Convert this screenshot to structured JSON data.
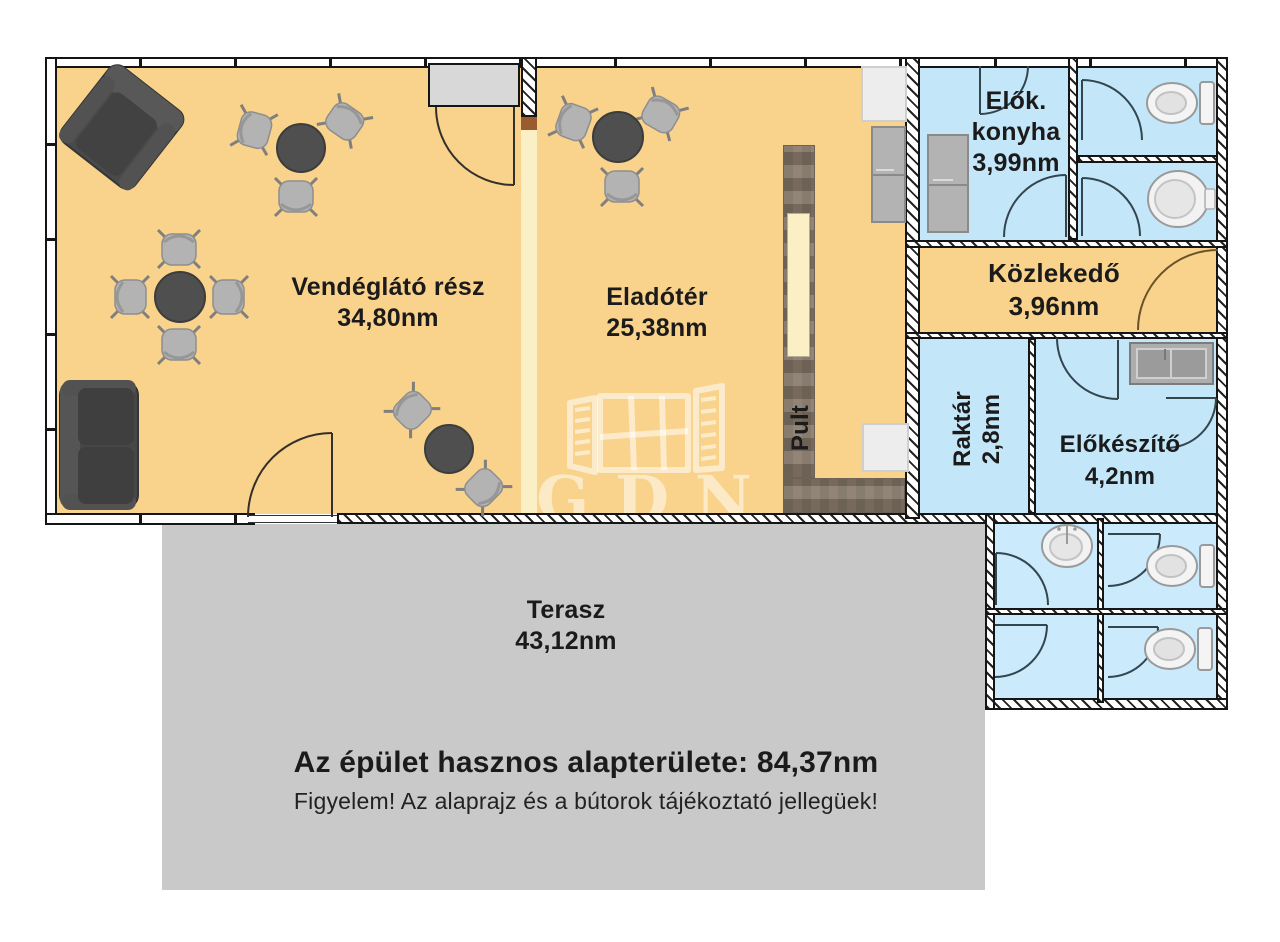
{
  "rooms": {
    "vendeglato": {
      "name": "Vendéglátó rész",
      "area": "34,80nm"
    },
    "eladoter": {
      "name": "Eladótér",
      "area": "25,38nm"
    },
    "konyha": {
      "line1": "Elők.",
      "line2": "konyha",
      "area": "3,99nm"
    },
    "kozlekedo": {
      "name": "Közlekedő",
      "area": "3,96nm"
    },
    "raktar": {
      "name": "Raktár",
      "area": "2,8nm"
    },
    "elokeszito": {
      "name": "Előkészítő",
      "area": "4,2nm"
    },
    "pult": {
      "name": "Pult"
    },
    "terasz": {
      "name": "Terasz",
      "area": "43,12nm"
    }
  },
  "footer": {
    "total_label": "Az épület hasznos alapterülete: 84,37nm",
    "disclaimer": "Figyelem! Az alaprajz és a bútorok tájékoztató jellegüek!"
  },
  "watermark": {
    "brand": "GDN"
  },
  "icons": [
    "toilet-icon",
    "sink-icon",
    "washbasin-icon",
    "door-arc-icon",
    "fridge-icon",
    "counter",
    "table-icon",
    "chair-icon",
    "sofa-icon",
    "armchair-icon",
    "window-logo-icon"
  ],
  "colors": {
    "floor_main": "#F9D28C",
    "floor_secondary": "#C3E6F8",
    "floor_secondary_light": "#CBEAFB",
    "terrace": "#C9C9C9",
    "counter": "#8A7B6C",
    "partition_cream": "#FBEFC6",
    "wall_line": "#151515",
    "entrance_glass": "#D8D8D8",
    "label_text": "#1B1B1B"
  }
}
